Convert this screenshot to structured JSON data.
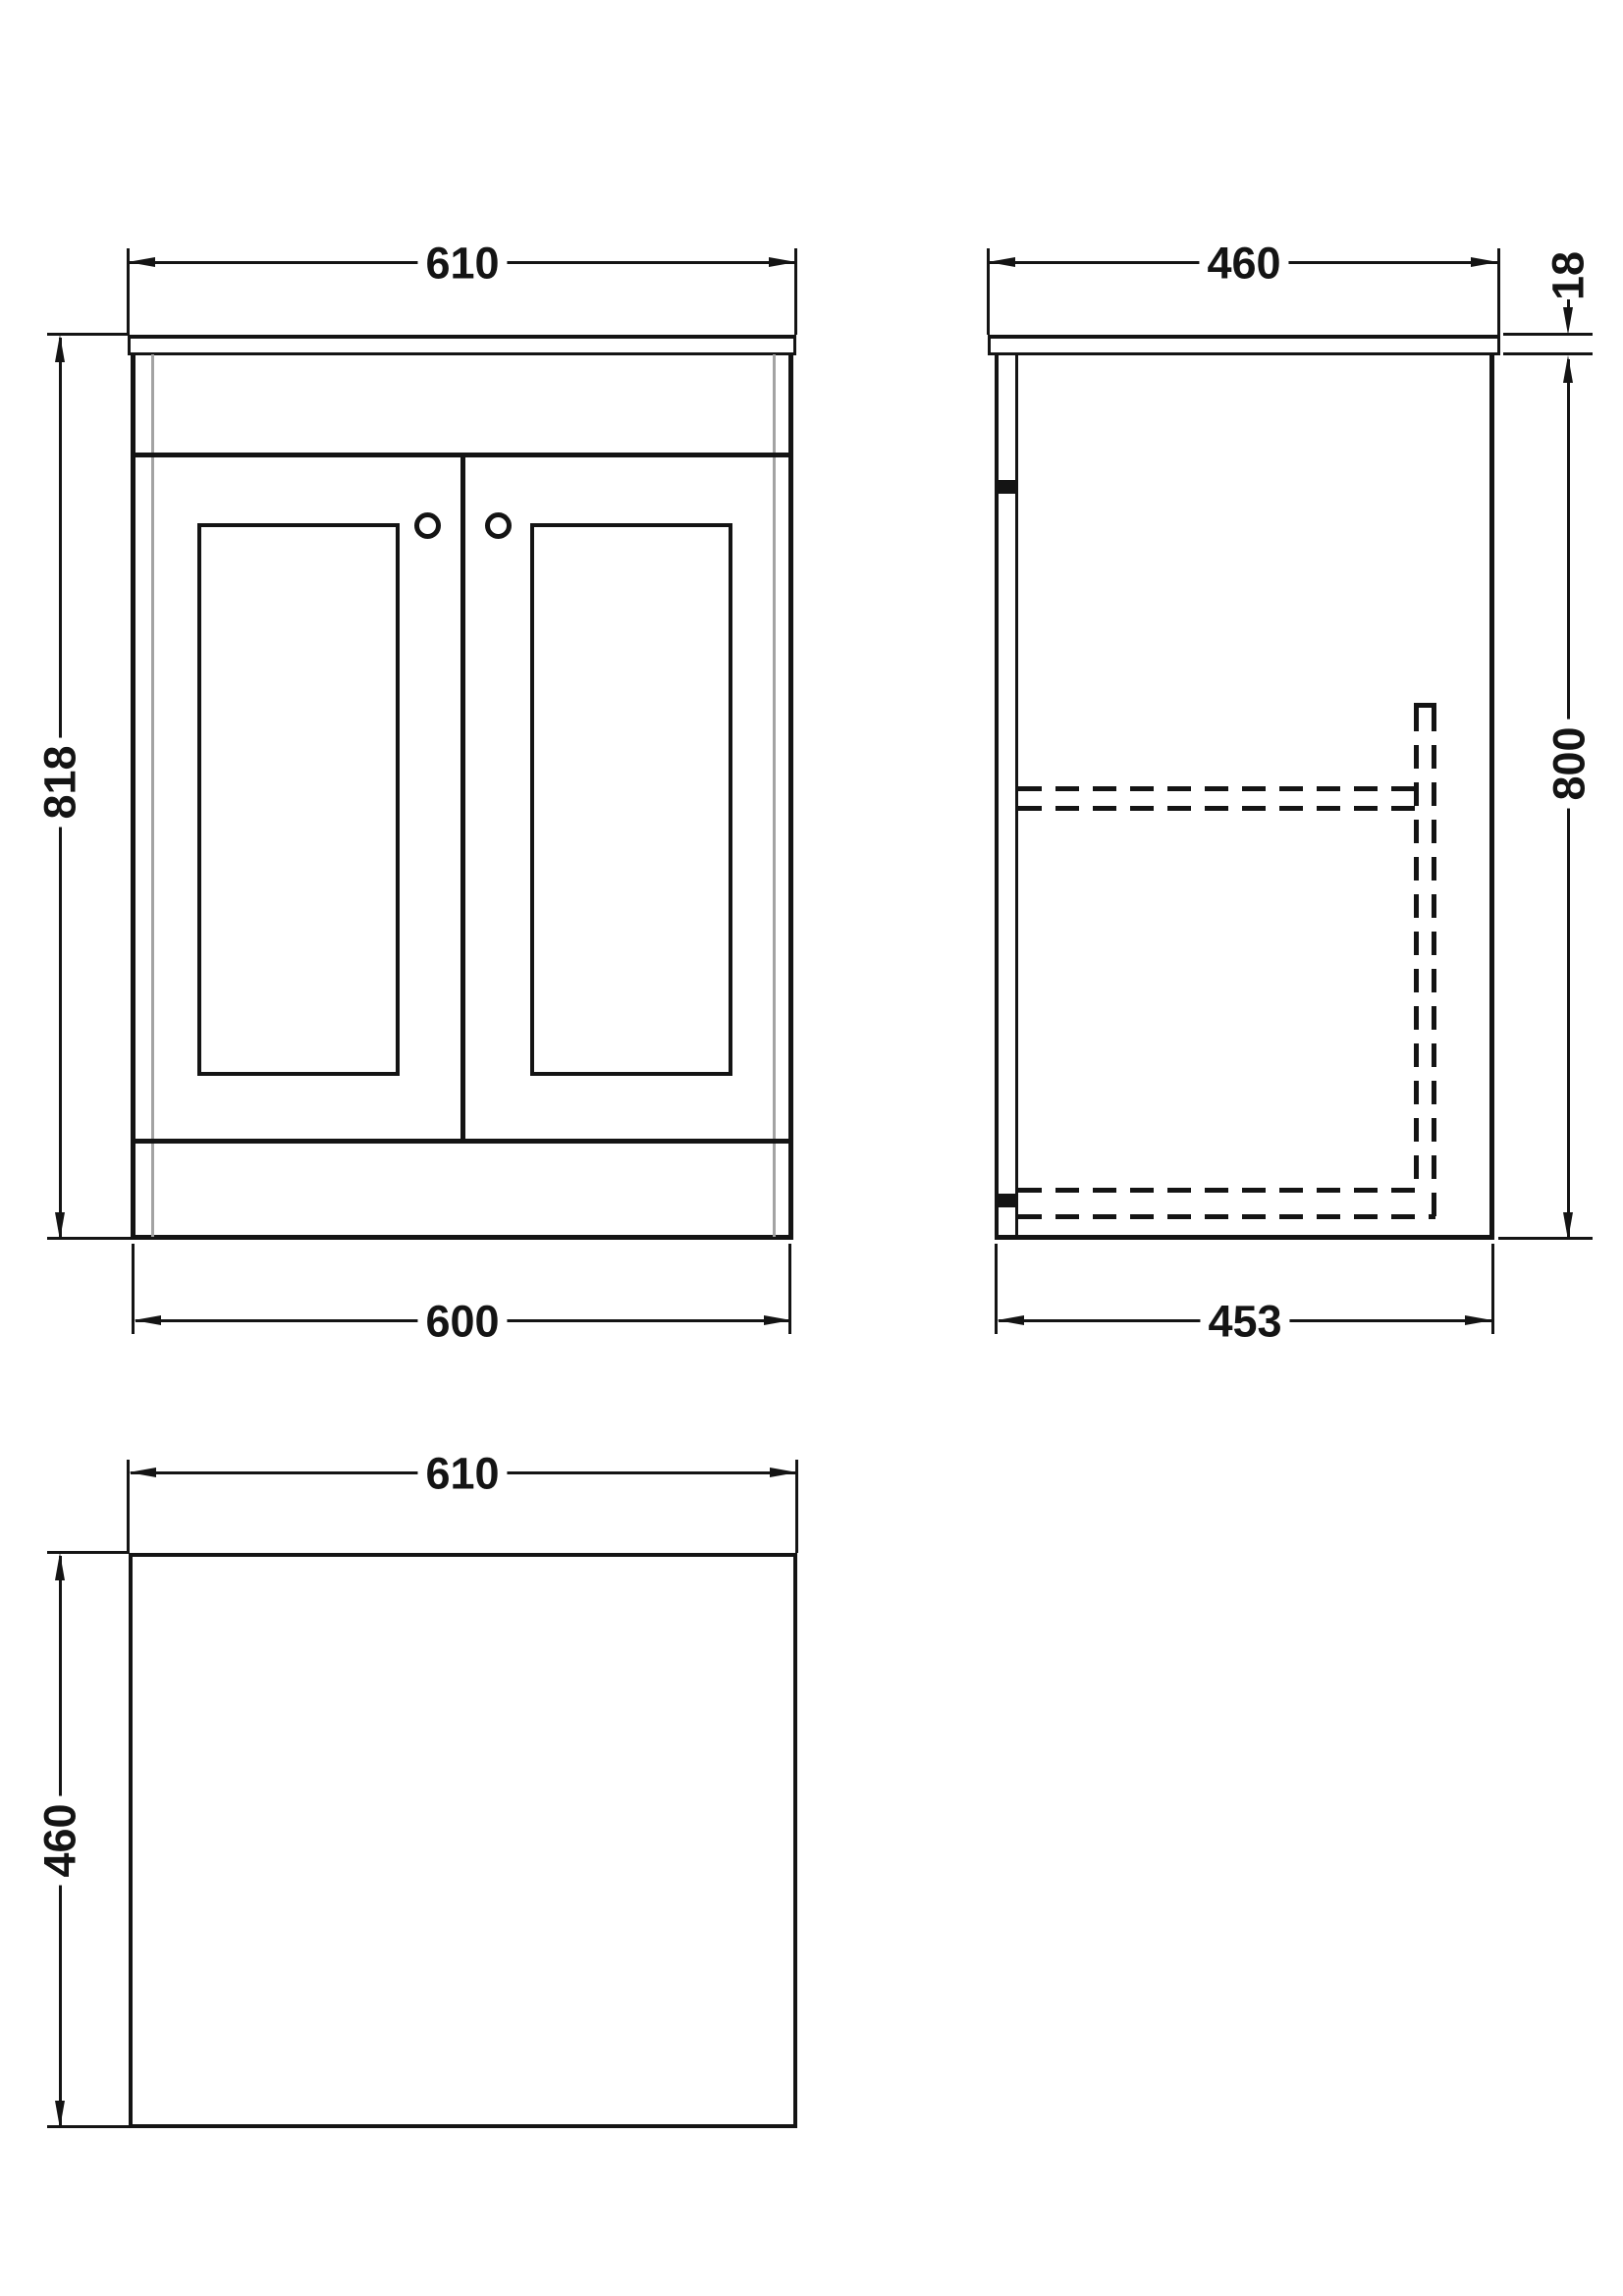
{
  "drawing": {
    "front_view": {
      "width_top": "610",
      "height_overall": "818",
      "width_bottom": "600"
    },
    "side_view": {
      "depth_top": "460",
      "worktop_thickness": "18",
      "height_body": "800",
      "depth_bottom": "453"
    },
    "plan_view": {
      "width": "610",
      "depth": "460"
    },
    "colors": {
      "line": "#141414",
      "accent_gray": "#a3a3a3",
      "background": "#ffffff"
    }
  }
}
